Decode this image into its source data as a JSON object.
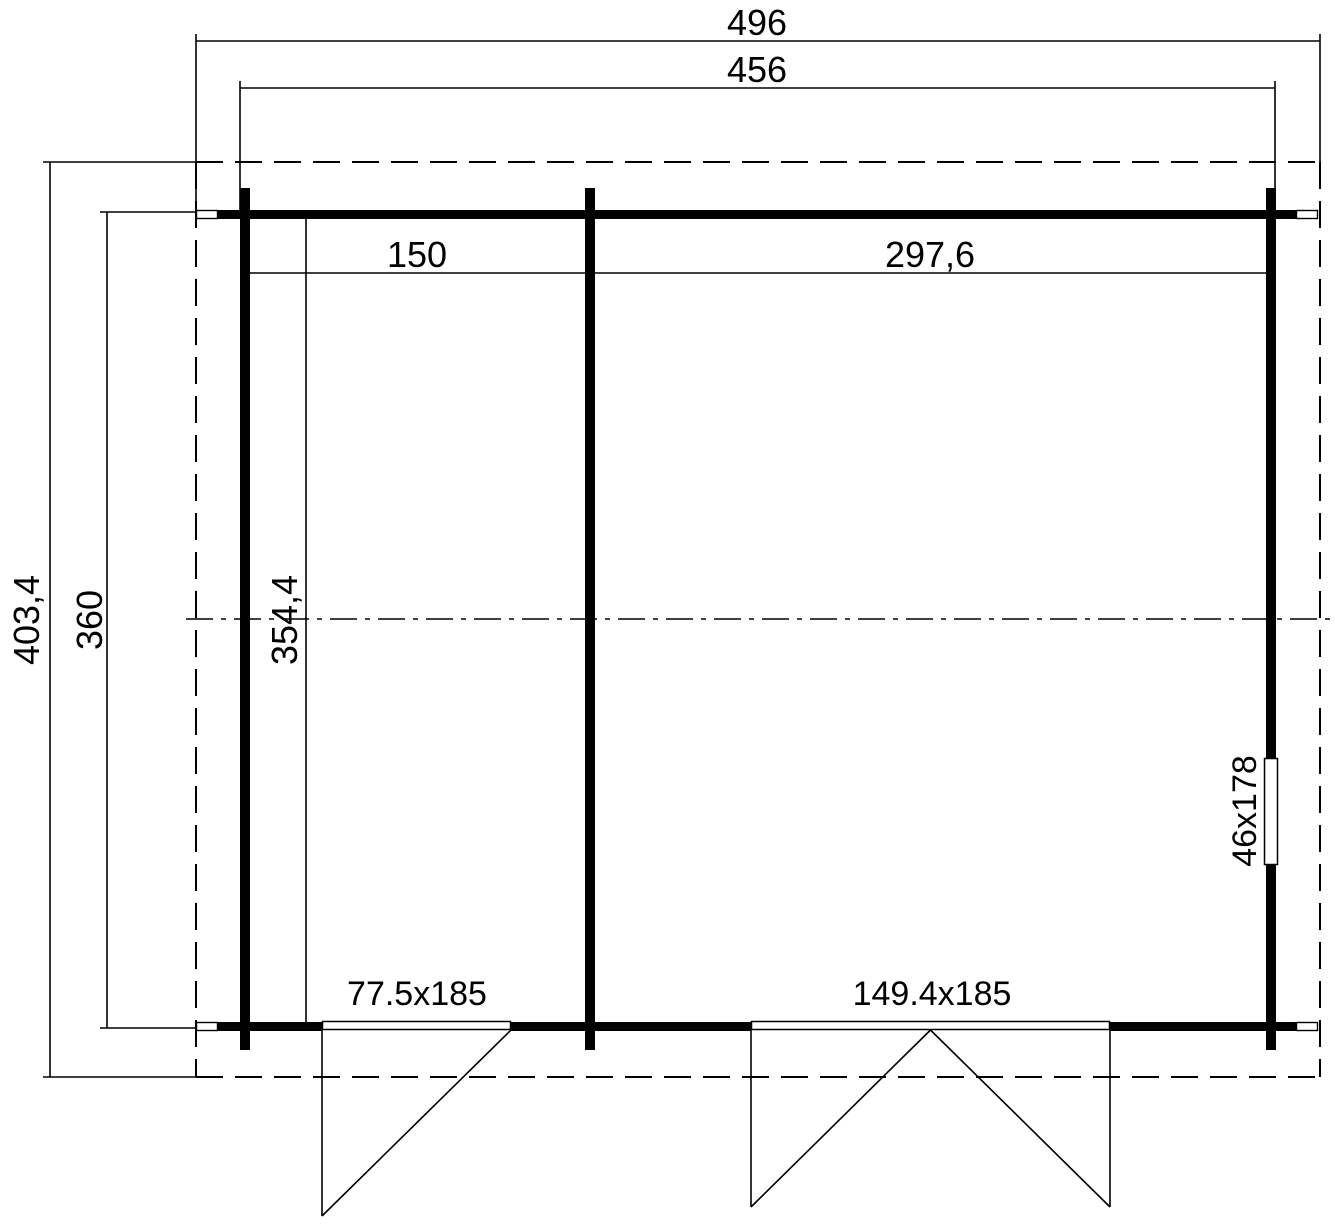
{
  "drawing": {
    "type": "floor-plan",
    "units": "cm",
    "colors": {
      "line": "#000000",
      "background": "#ffffff"
    },
    "dimensions": {
      "roof_width": "496",
      "wall_width": "456",
      "roof_depth": "403,4",
      "wall_depth": "360",
      "room_left_width": "150",
      "room_right_width": "297,6",
      "interior_depth": "354,4"
    },
    "openings": {
      "window_right": "46x178",
      "door_left": "77.5x185",
      "door_double": "149.4x185"
    }
  }
}
